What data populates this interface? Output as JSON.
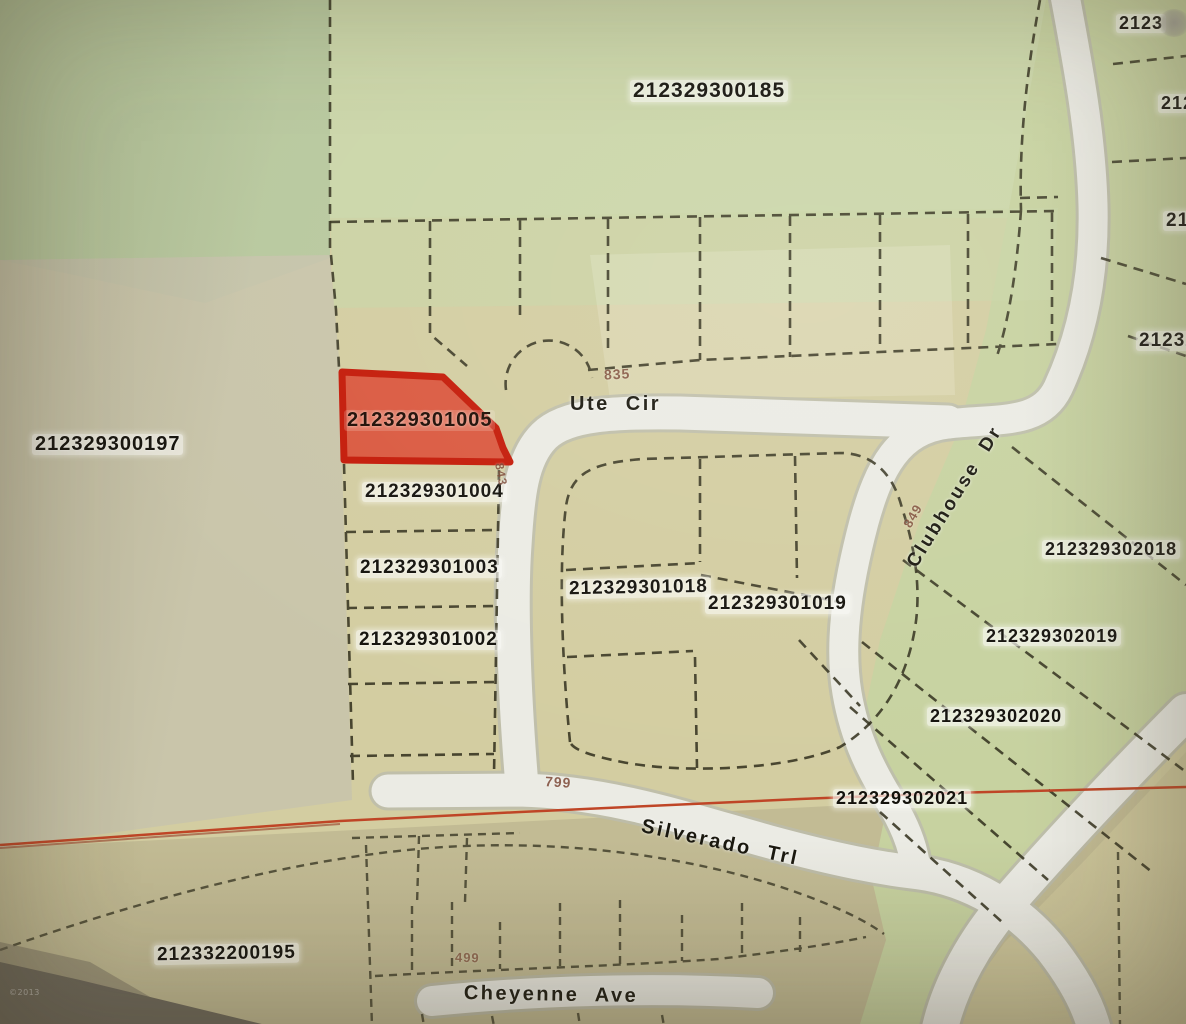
{
  "map": {
    "parcels": {
      "p185": {
        "id": "212329300185",
        "highlighted": false
      },
      "p197": {
        "id": "212329300197",
        "highlighted": false
      },
      "p1005": {
        "id": "212329301005",
        "highlighted": true
      },
      "p1004": {
        "id": "212329301004",
        "highlighted": false
      },
      "p1003": {
        "id": "212329301003",
        "highlighted": false
      },
      "p1002": {
        "id": "212329301002",
        "highlighted": false
      },
      "p1018": {
        "id": "212329301018",
        "highlighted": false
      },
      "p1019": {
        "id": "212329301019",
        "highlighted": false
      },
      "p2018": {
        "id": "212329302018",
        "highlighted": false
      },
      "p2019": {
        "id": "212329302019",
        "highlighted": false
      },
      "p2020": {
        "id": "212329302020",
        "highlighted": false
      },
      "p2021": {
        "id": "212329302021",
        "highlighted": false
      },
      "p195": {
        "id": "212332200195",
        "highlighted": false
      }
    },
    "partial_parcels": {
      "tr1": "2123",
      "tr2": "212",
      "tr3": "21",
      "tr4": "21232"
    },
    "streets": {
      "ute": {
        "name": "Ute Cir"
      },
      "clubhouse": {
        "name": "Clubhouse Dr"
      },
      "silverado": {
        "name": "Silverado Trl"
      },
      "cheyenne": {
        "name": "Cheyenne Ave"
      }
    },
    "addresses": {
      "a835": "835",
      "a843": "843",
      "a849": "849",
      "a799": "799",
      "a499": "499"
    },
    "watermark": "©2013",
    "highlighted_parcel": "212329301005",
    "colors": {
      "highlight_fill": "#dc3c28",
      "highlight_border": "#c41a08",
      "survey_line": "#bf4526",
      "road_fill": "#ebebe4",
      "parcel_line": "#34321f",
      "label_text": "#14120c",
      "address_text": "#7d4a38"
    }
  }
}
